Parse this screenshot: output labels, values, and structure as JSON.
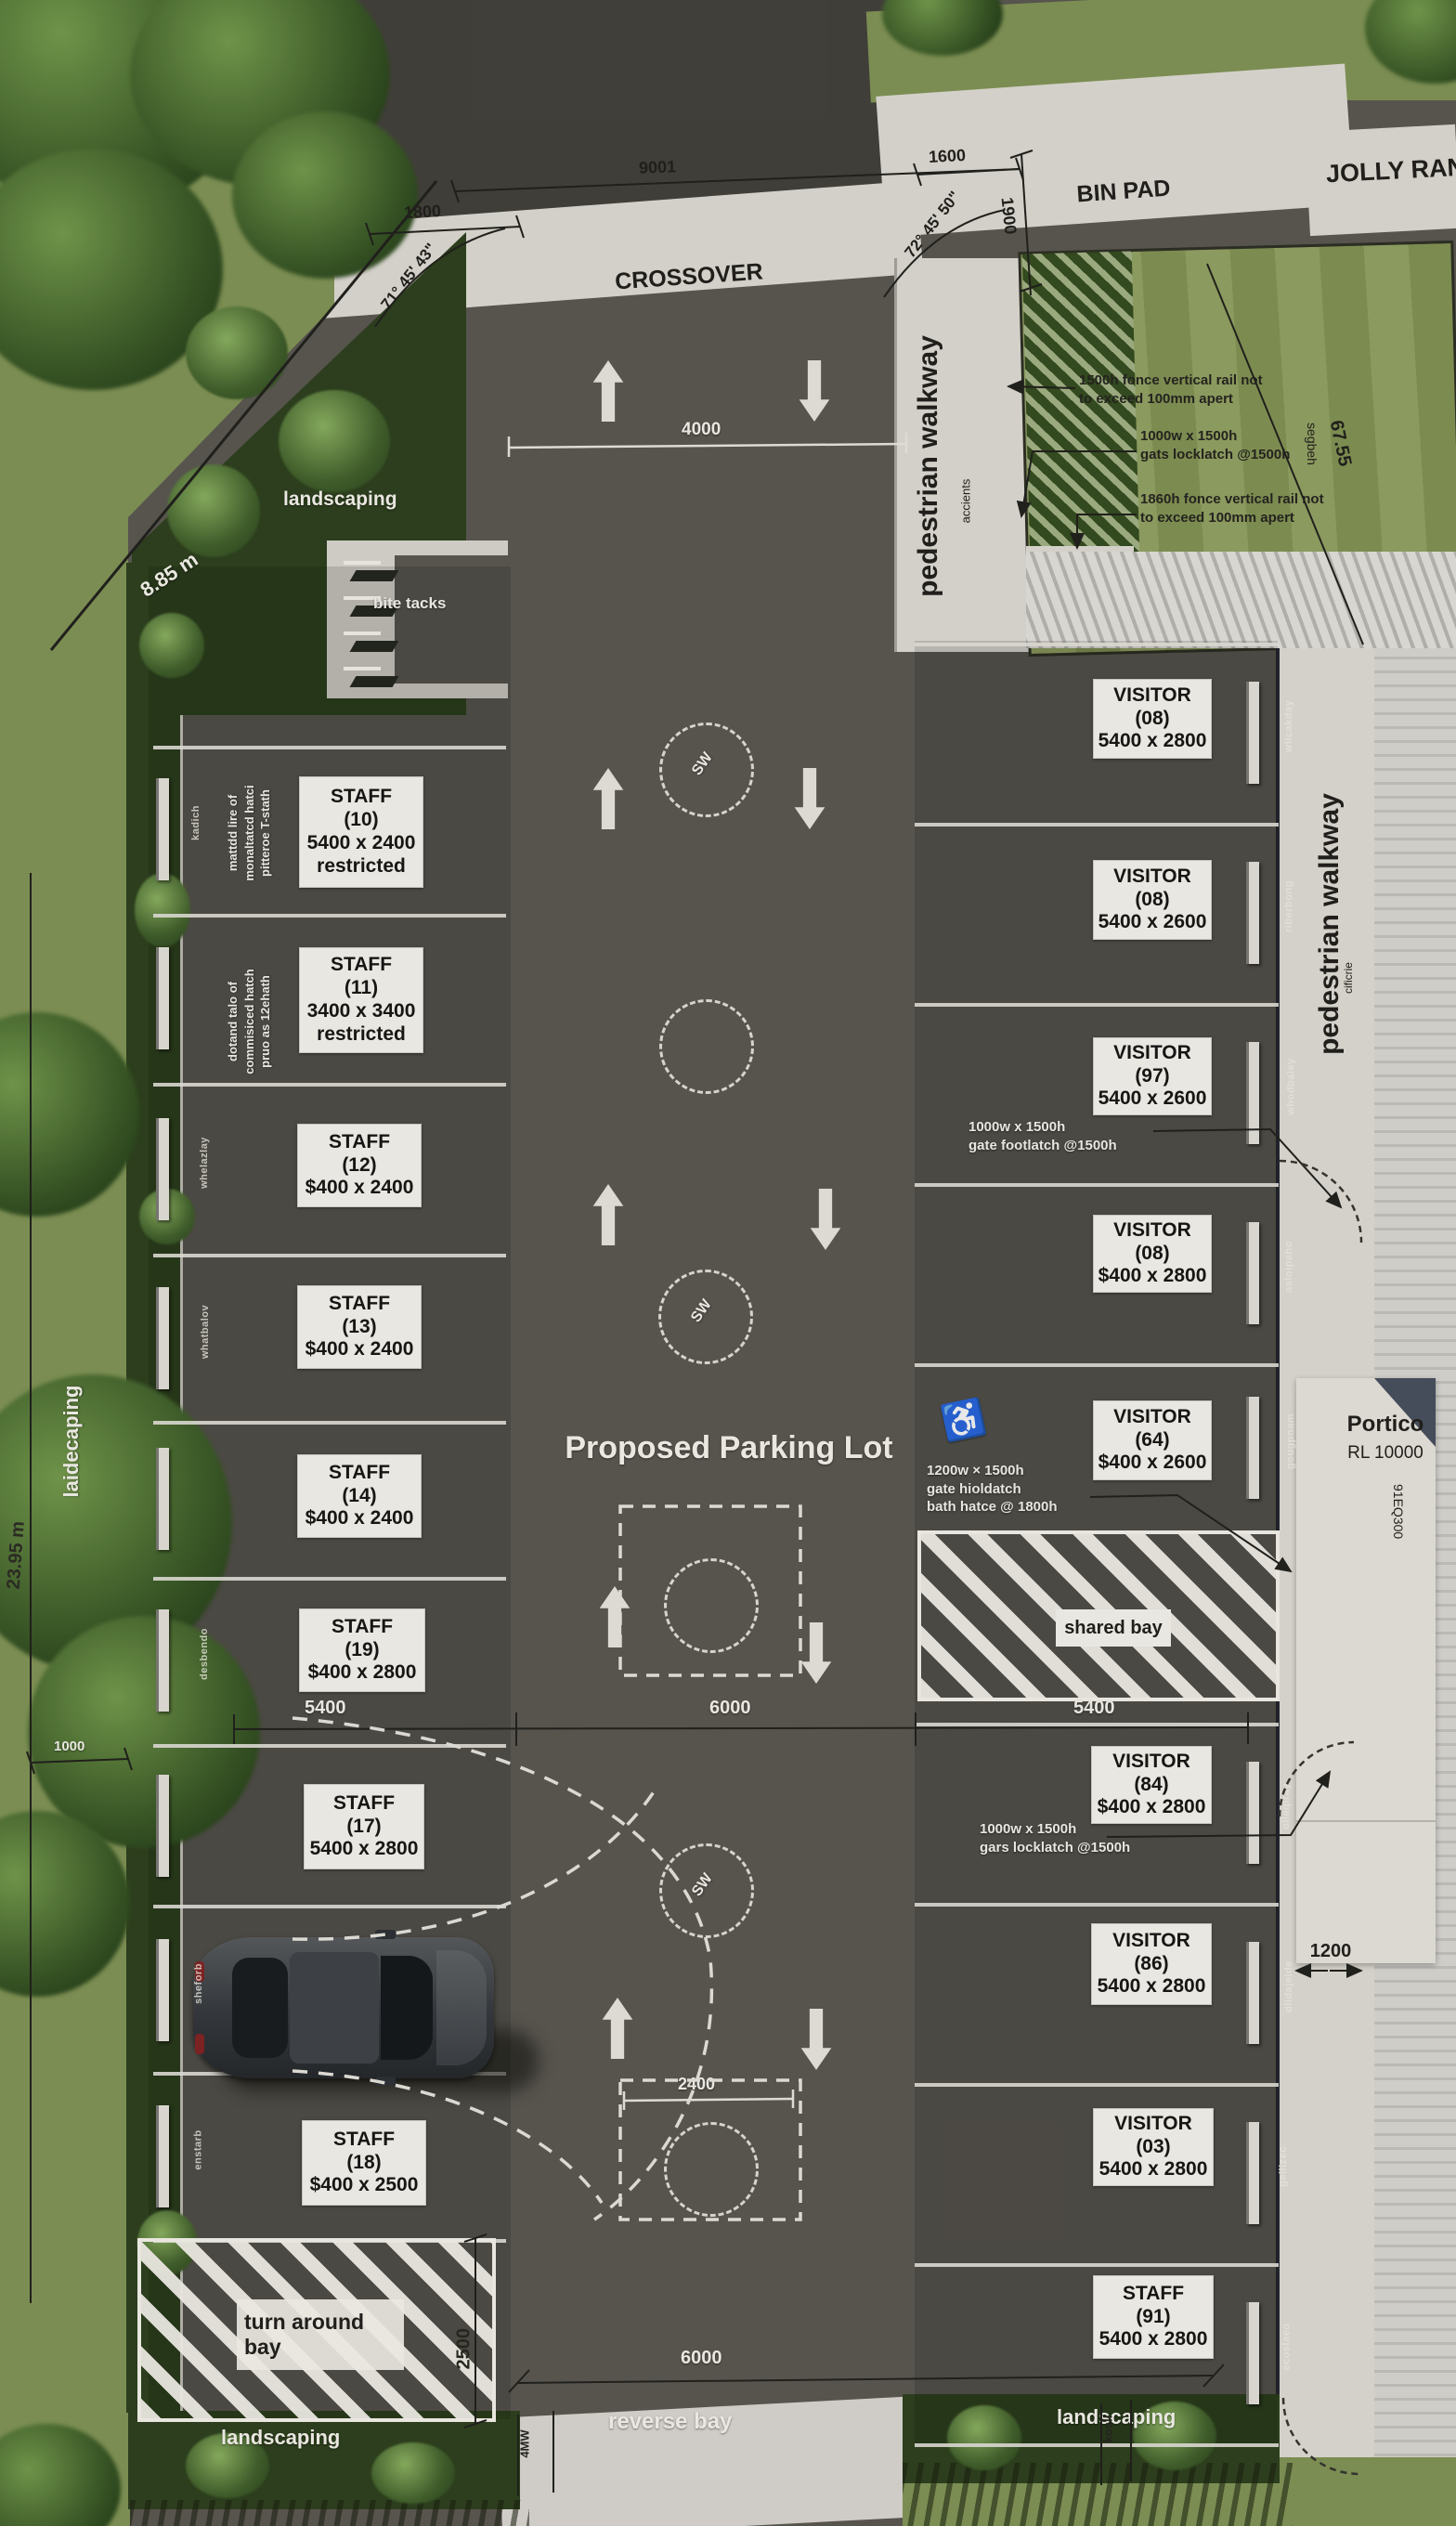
{
  "title": "Proposed Parking Lot",
  "top": {
    "crossover": "CROSSOVER",
    "bin_pad": "BIN PAD",
    "street": "JOLLY RAN",
    "dim_1800": "1800",
    "dim_9001": "9001",
    "dim_1600": "1600",
    "dim_1900": "1900",
    "angle_left": "71° 45' 43\"",
    "angle_right": "72° 45' 50\"",
    "dim_4000": "4000"
  },
  "right_top": {
    "walkway": "pedestrian walkway",
    "walkway_sub": "accients",
    "note_fence1_l1": "1500h fonce vertical rail not",
    "note_fence1_l2": "to exceed 100mm apert",
    "note_gate_l1": "1000w x 1500h",
    "note_gate_l2": "gats locklatch @1500h",
    "note_fence2_l1": "1860h fonce vertical rail not",
    "note_fence2_l2": "to exceed 100mm apert",
    "dim_6755": "67.55",
    "hedge": "segbeh"
  },
  "right_mid": {
    "walkway": "pedestrian walkway",
    "walkway_sub": "cificrie",
    "note_foot_l1": "1000w x 1500h",
    "note_foot_l2": "gate footlatch @1500h",
    "note_hold_l1": "1200w × 1500h",
    "note_hold_l2": "gate hioldatch",
    "note_hold_l3": "bath hatce @ 1800h",
    "note_lock_l1": "1000w x 1500h",
    "note_lock_l2": "gars locklatch @1500h",
    "accessible_icon": "♿"
  },
  "portico": {
    "name": "Portico",
    "rl": "RL 10000",
    "side": "91EQ300"
  },
  "staff_bays": [
    {
      "name": "STAFF",
      "num": "(10)",
      "size": "5400 x 2400",
      "extra": "restricted"
    },
    {
      "name": "STAFF",
      "num": "(11)",
      "size": "3400 x 3400",
      "extra": "restricted"
    },
    {
      "name": "STAFF",
      "num": "(12)",
      "size": "$400 x 2400"
    },
    {
      "name": "STAFF",
      "num": "(13)",
      "size": "$400 x 2400"
    },
    {
      "name": "STAFF",
      "num": "(14)",
      "size": "$400 x 2400"
    },
    {
      "name": "STAFF",
      "num": "(19)",
      "size": "$400 x 2800"
    },
    {
      "name": "STAFF",
      "num": "(17)",
      "size": "5400 x 2800"
    },
    {
      "name": "STAFF",
      "num": "(18)",
      "size": "$400 x 2500"
    },
    {
      "name": "STAFF",
      "num": "(91)",
      "size": "5400 x 2800"
    }
  ],
  "visitor_bays": [
    {
      "name": "VISITOR",
      "num": "(08)",
      "size": "5400 x 2800"
    },
    {
      "name": "VISITOR",
      "num": "(08)",
      "size": "5400 x 2600"
    },
    {
      "name": "VISITOR",
      "num": "(97)",
      "size": "5400 x 2600"
    },
    {
      "name": "VISITOR",
      "num": "(08)",
      "size": "$400 x 2800"
    },
    {
      "name": "VISITOR",
      "num": "(64)",
      "size": "$400 x 2600"
    },
    {
      "name": "VISITOR",
      "num": "(84)",
      "size": "$400 x 2800"
    },
    {
      "name": "VISITOR",
      "num": "(86)",
      "size": "5400 x 2800"
    },
    {
      "name": "VISITOR",
      "num": "(03)",
      "size": "5400 x 2800"
    }
  ],
  "staff_notes": {
    "s10_l1": "mattdd lire of",
    "s10_l2": "monaltatcd hatci",
    "s10_l3": "pitteroe T-stath",
    "s11_l1": "dotand talo of",
    "s11_l2": "commisiced hatch",
    "s11_l3": "pruo as 12ehath"
  },
  "zones": {
    "shared": "shared bay",
    "turn_l1": "turn around",
    "turn_l2": "bay",
    "reverse": "reverse bay",
    "bike": "bite tacks",
    "landscaping_tl": "landscaping",
    "landscaping_left": "laidecaping",
    "landscaping_bl": "landscaping",
    "landscaping_br": "landscaping",
    "sw": "SW"
  },
  "site_dims": {
    "d885": "8.85 m",
    "d2395": "23.95 m",
    "d1000": "1000",
    "d5400l": "5400",
    "d6000": "6000",
    "d5400r": "5400",
    "d2400": "2400",
    "d2500": "2500",
    "d6000b": "6000",
    "d1200": "1200",
    "vleft": "4MW",
    "vright": "kosll"
  },
  "micro": {
    "r1": "wllcakday",
    "r2": "riberbong",
    "r3": "whodbaley",
    "r4": "asloipaho",
    "r5": "gougpnam",
    "r6": "ollaqlray",
    "r7": "dlidajelde",
    "r8": "geilizec",
    "r9": "ecoslaeo",
    "l1": "kadich",
    "l2": "whelazlay",
    "l3": "whatbalov",
    "l4": "desbendo",
    "l5": "sheforb",
    "l6": "enstarb"
  }
}
